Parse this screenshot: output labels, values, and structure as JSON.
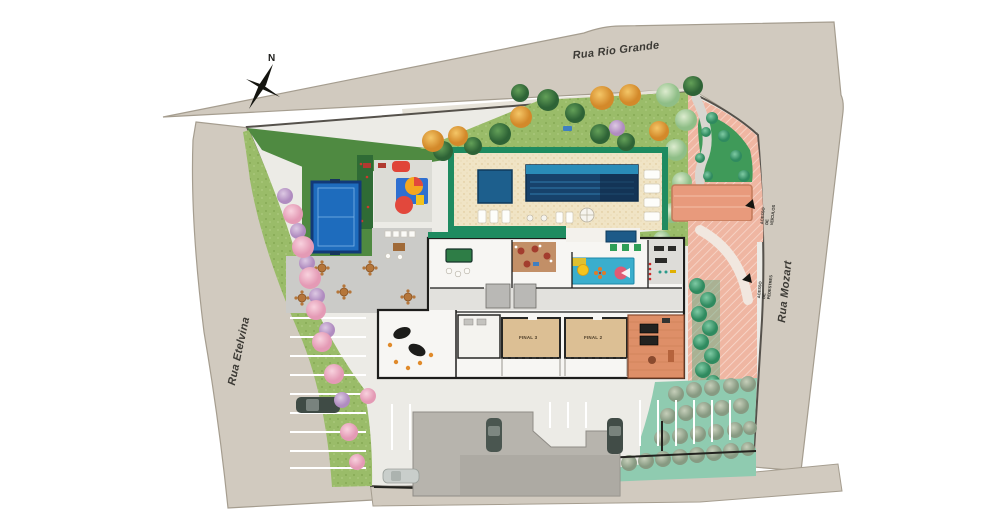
{
  "plan": {
    "streets": {
      "top": "Rua Rio Grande",
      "right": "Rua Mozart",
      "left": "Rua Etelvina"
    },
    "compass_north": "N",
    "access": {
      "vehicles": "ACESSO DE VEÍCULOS",
      "pedestrians": "ACESSO DE PEDESTRES"
    },
    "units": {
      "left": "FINAL 3",
      "right": "FINAL 2"
    }
  },
  "colors": {
    "bg": "#ffffff",
    "street": "#d1cabf",
    "street-edge": "#a59d8f",
    "sidewalk": "#e7e3d9",
    "lot": "#ecebe6",
    "lawn": "#9abc69",
    "lawn-dark": "#4f8a41",
    "deck": "#f0e4c5",
    "deck-trim": "#1f8b60",
    "pool": "#17426b",
    "pool-light": "#2a8cb8",
    "court": "#1e6cbd",
    "court-border": "#123a78",
    "terrace": "#cbcbc8",
    "building-floor": "#f7f6f3",
    "wall": "#1d1d1b",
    "unit": "#dcbf94",
    "gourmet": "#c28f67",
    "playroom": "#3aaecd",
    "bbq-deck": "#de8f68",
    "plaza": "#efb6a2",
    "roof": "#e89a7c",
    "ramp": "#b7b4ad",
    "teal-ground": "#8fcbb0"
  }
}
